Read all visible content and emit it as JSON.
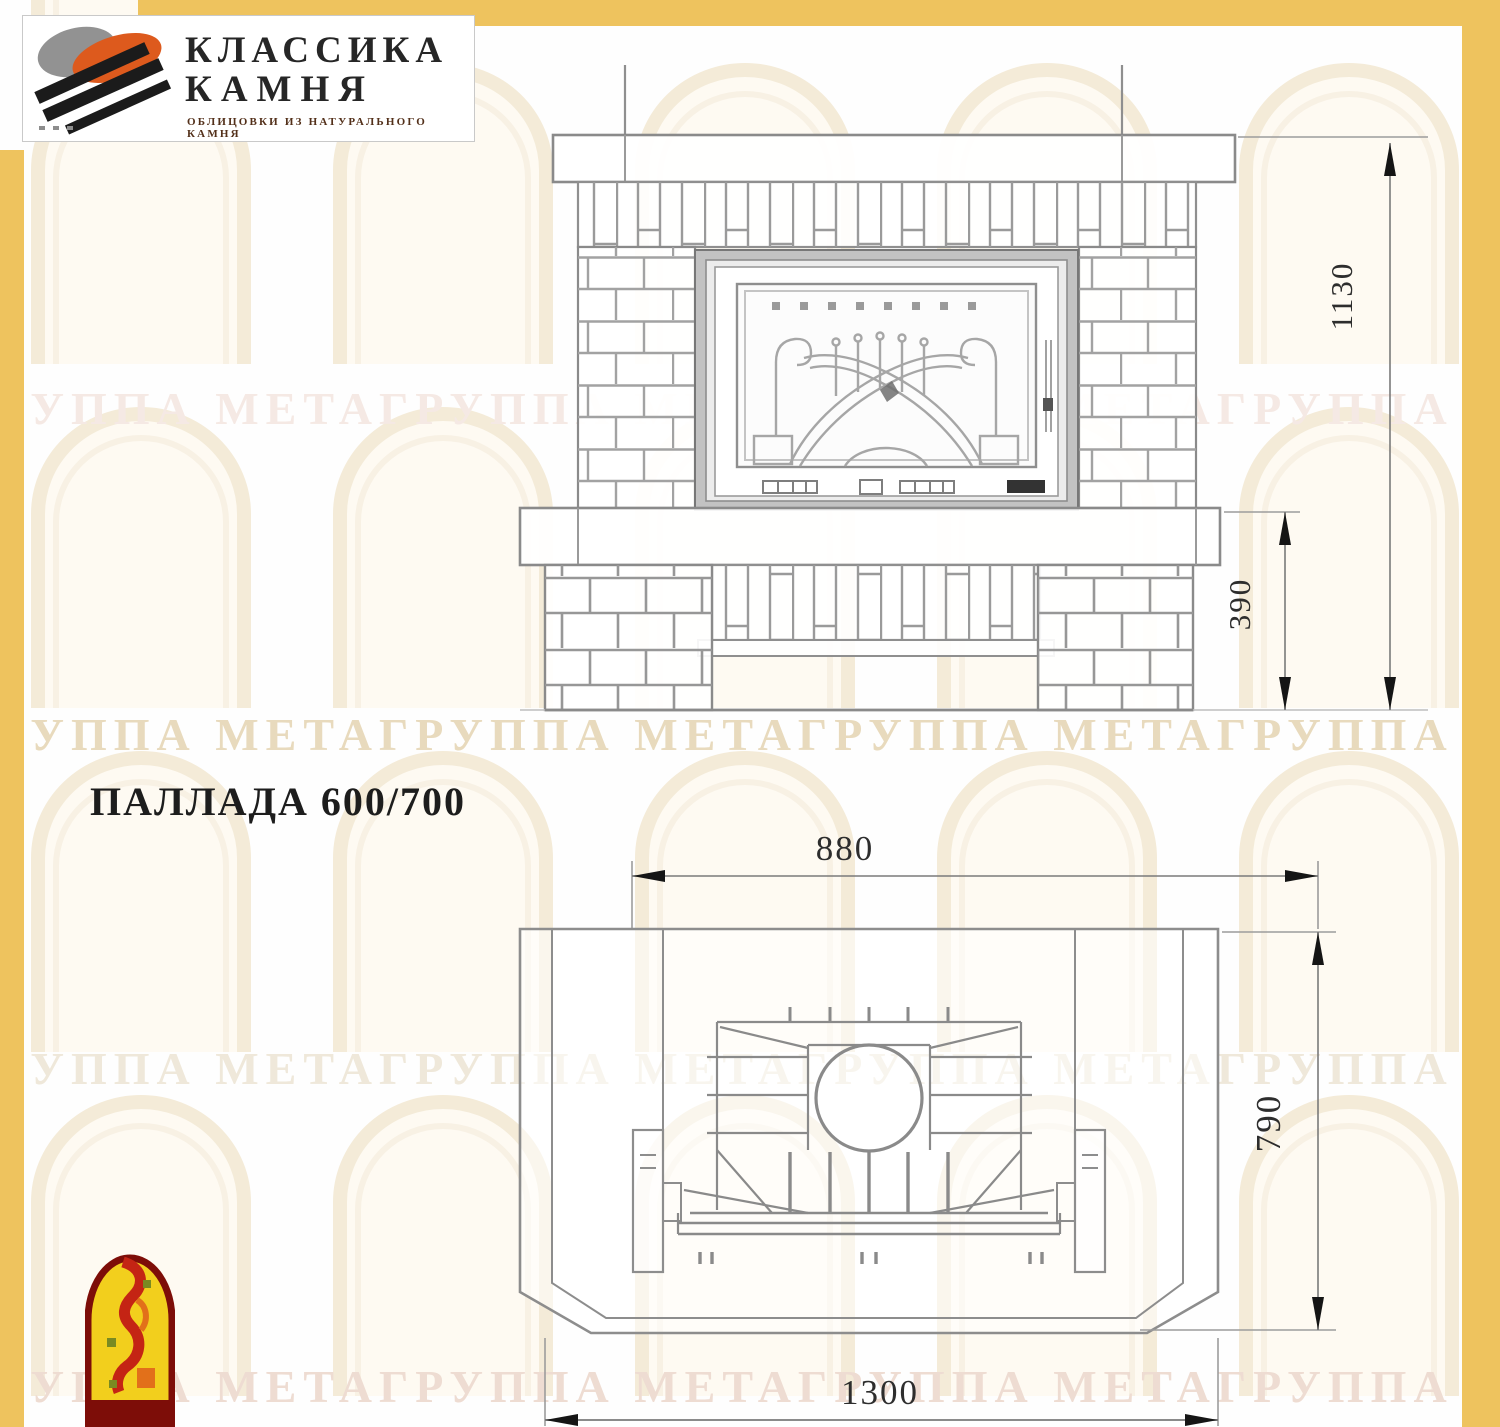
{
  "logo": {
    "line1": "КЛАССИКА",
    "line2": "КАМНЯ",
    "tagline": "ОБЛИЦОВКИ ИЗ НАТУРАЛЬНОГО КАМНЯ"
  },
  "title": "ПАЛЛАДА 600/700",
  "watermark": {
    "text": "ГРУППА МЕТАГРУППА МЕТАГРУППА МЕТАГРУППА МЕТАГРУППА МЕТА"
  },
  "front_view": {
    "dim_height_total": "1130",
    "dim_hearth_height": "390"
  },
  "plan_view": {
    "dim_top_width": "880",
    "dim_depth": "790",
    "dim_front_width": "1300"
  },
  "colors": {
    "frame_yellow": "#eec35e",
    "line_grey": "#8a8a8a",
    "firebird_red": "#c42414",
    "firebird_yellow": "#f2cf1d"
  }
}
